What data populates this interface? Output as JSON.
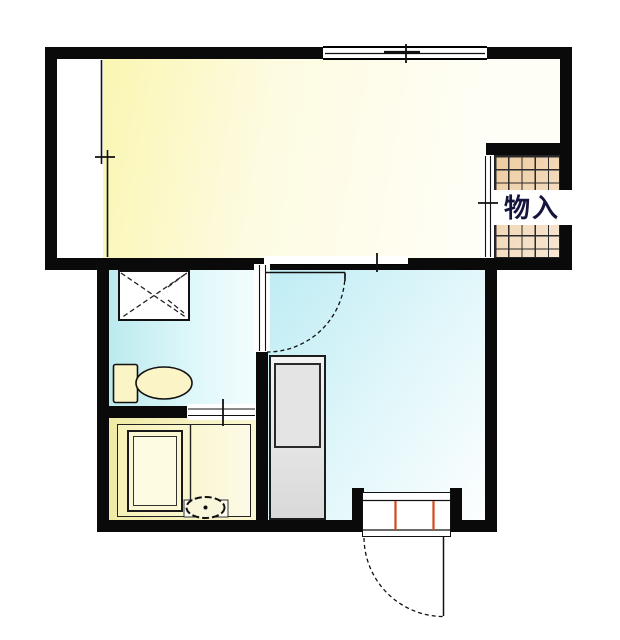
{
  "plan": {
    "labels": {
      "closet": "物入"
    },
    "colors": {
      "wall": "#0a0a0a",
      "line": "#111111",
      "room_yellow_a": "#faf6b2",
      "room_yellow_b": "#fffef6",
      "wet_cyan_a": "#bceaee",
      "wet_cyan_b": "#f3fdff",
      "kitchen_a": "#beecf4",
      "kitchen_b": "#fdfeff",
      "bath_a": "#efeba6",
      "bath_b": "#faf6d2",
      "bath_inner_a": "#f7f2b8",
      "bath_inner_b": "#fcfae6",
      "closet_a": "#edcb9e",
      "closet_b": "#f8e8d6",
      "grid_line": "#2a2a2a",
      "fixture_cream": "#faf4c6",
      "tub_fill": "#fbf7d2",
      "gray_unit_a": "#f3f3f3",
      "gray_unit_b": "#d9d9d9",
      "accent_orange": "#d2491a",
      "label_color": "#14143c"
    }
  }
}
